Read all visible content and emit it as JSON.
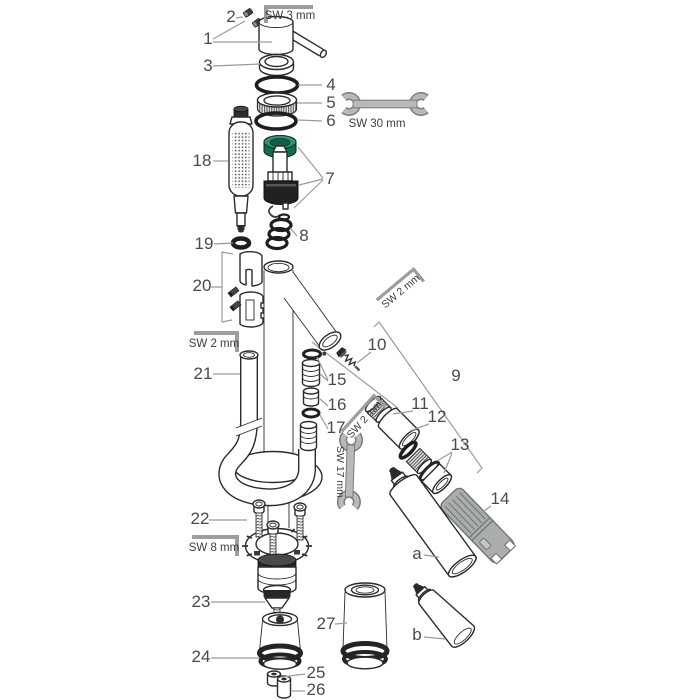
{
  "part_labels": {
    "p1": "1",
    "p2": "2",
    "p3": "3",
    "p4": "4",
    "p5": "5",
    "p6": "6",
    "p7": "7",
    "p8": "8",
    "p9": "9",
    "p10": "10",
    "p11": "11",
    "p12": "12",
    "p13": "13",
    "p14": "14",
    "p15": "15",
    "p16": "16",
    "p17": "17",
    "p18": "18",
    "p19": "19",
    "p20": "20",
    "p21": "21",
    "p22": "22",
    "p23": "23",
    "p24": "24",
    "p25": "25",
    "p26": "26",
    "p27": "27",
    "pa": "a",
    "pb": "b"
  },
  "tool_labels": {
    "sw3": "SW 3 mm",
    "sw30": "SW 30 mm",
    "sw2_top": "SW 2 mm",
    "sw2_mid": "SW 2 mm",
    "sw2_low": "SW 2 mm",
    "sw17": "SW 17 mm",
    "sw8": "SW 8 mm"
  },
  "colors": {
    "cartridge_cap_green": "#2E9377",
    "cartridge_cap_dark": "#166A52",
    "cartridge_cap_inner": "#135C48",
    "service_tool_gray": "#A9AEAA",
    "line_dark": "#2B2B2B",
    "leader_gray": "#9B9B9B",
    "label_gray": "#4A4A4A"
  }
}
